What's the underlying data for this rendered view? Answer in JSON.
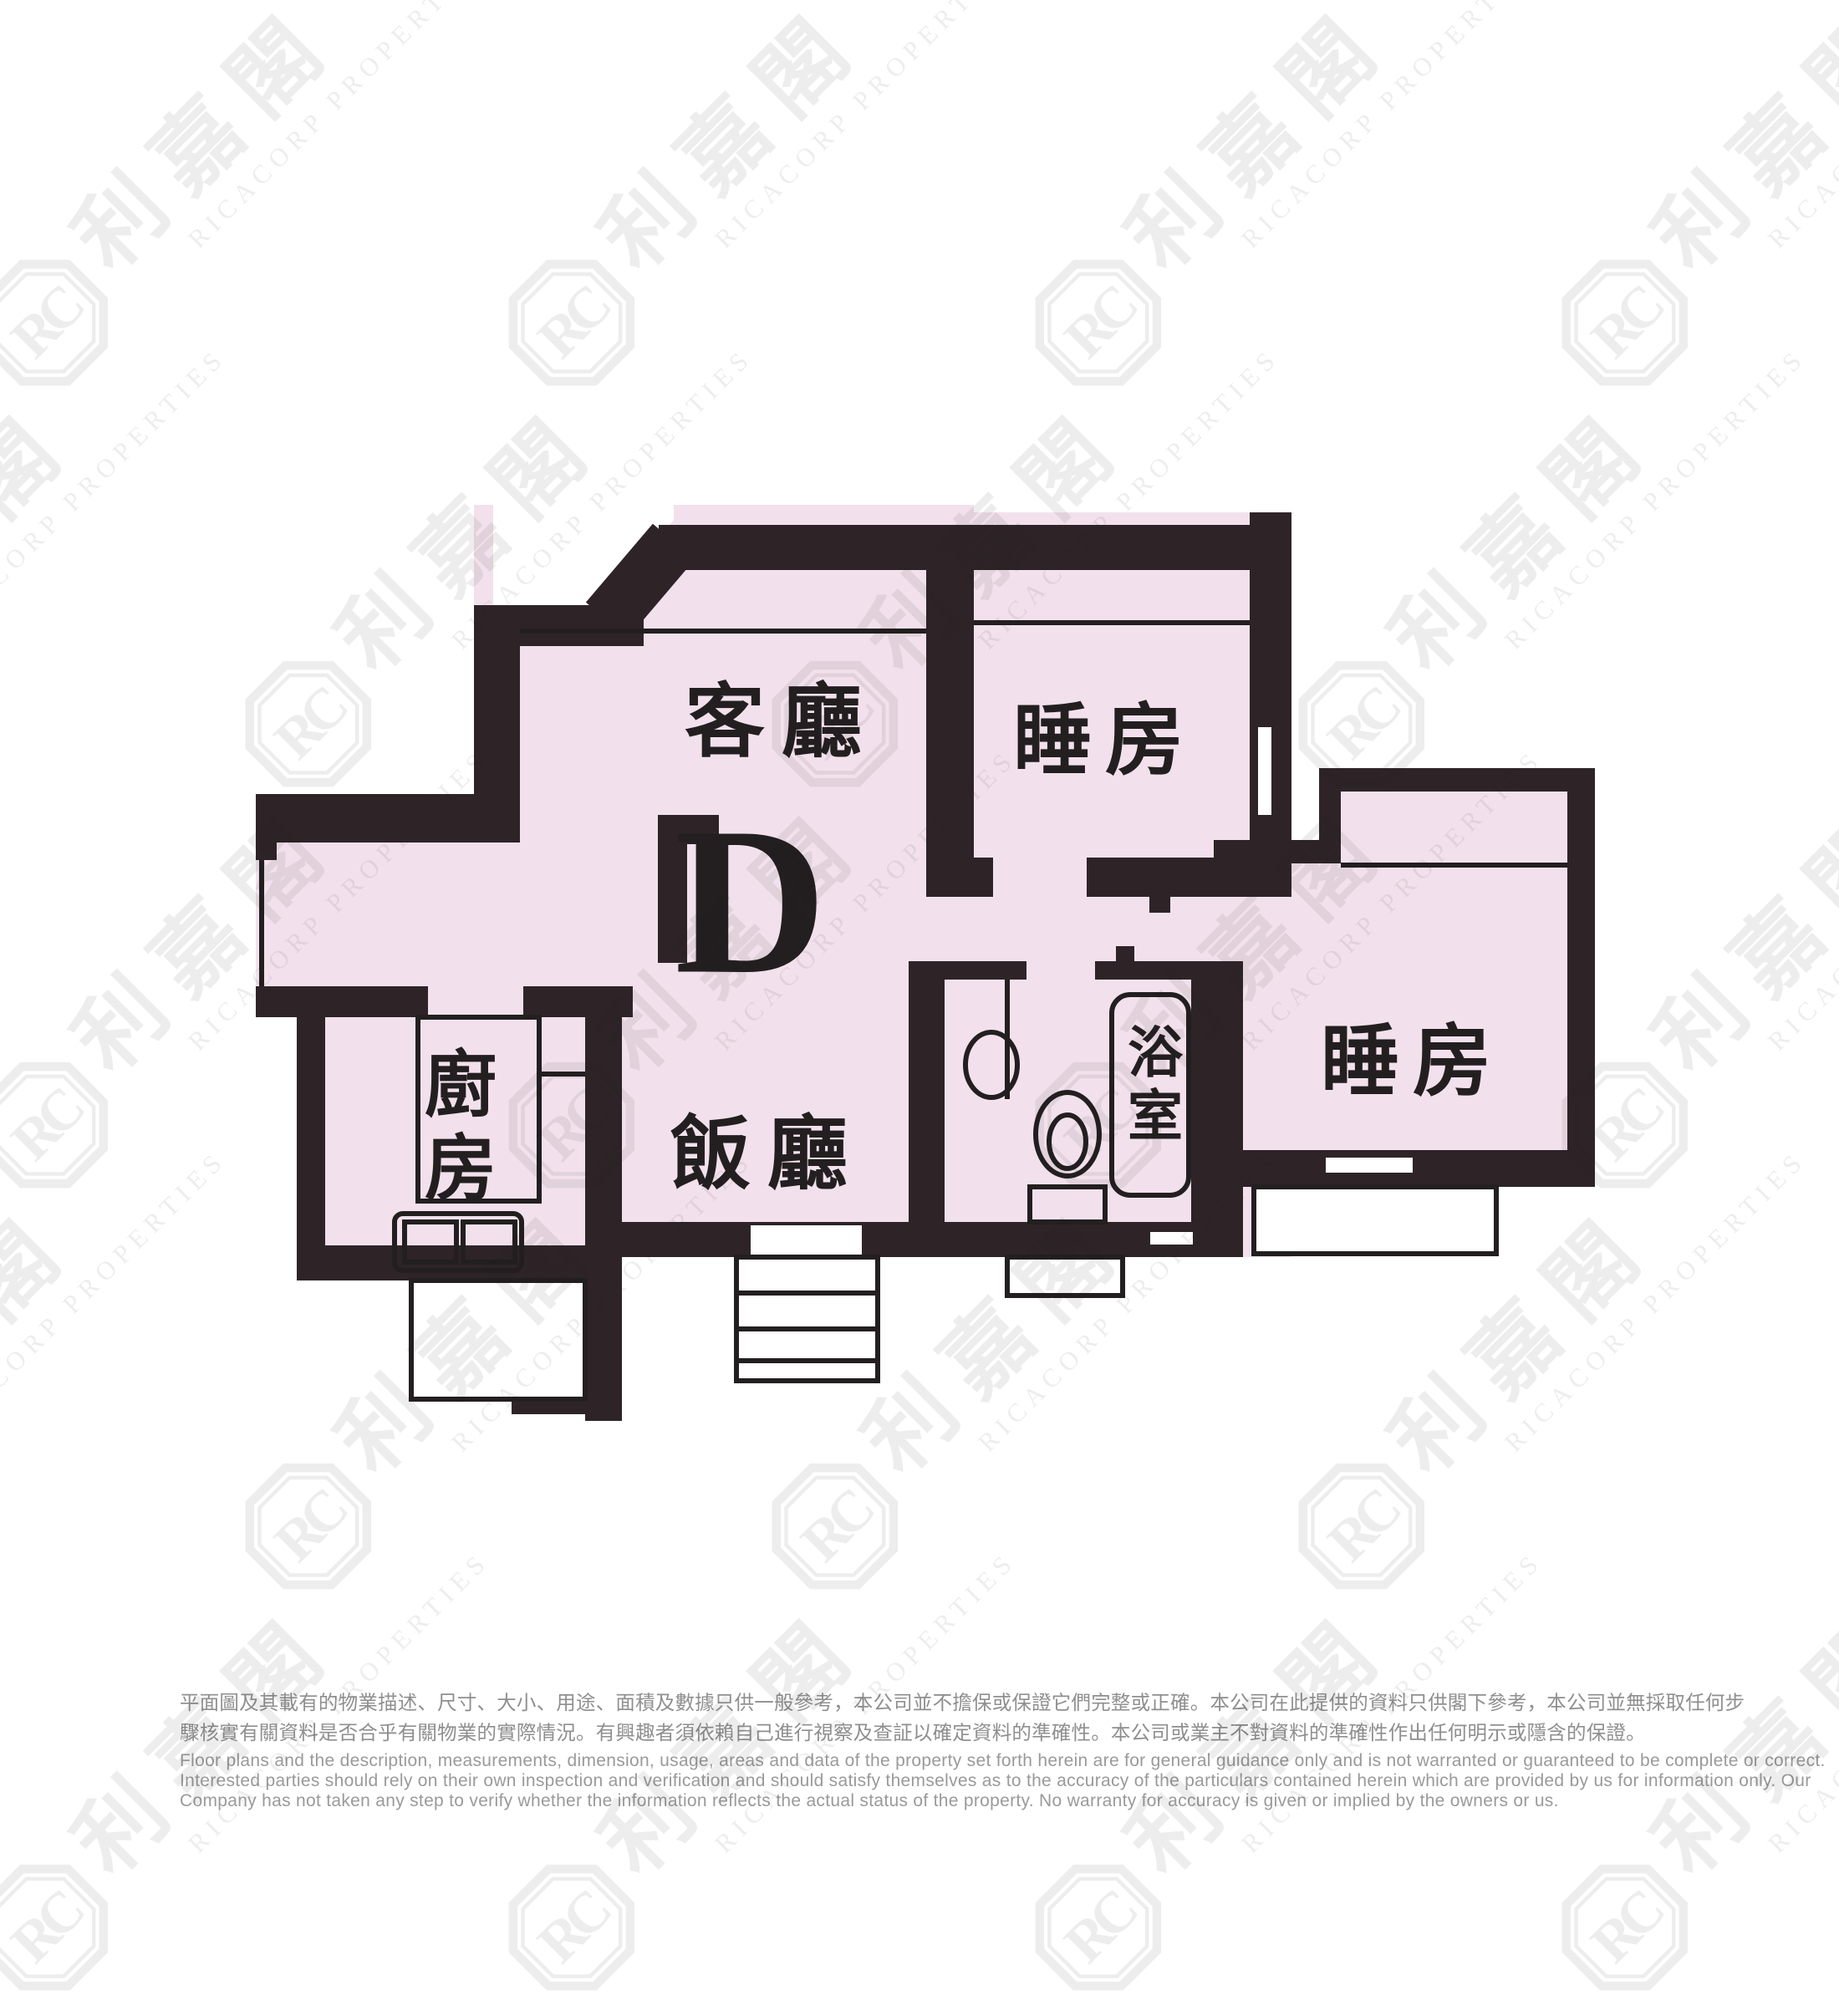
{
  "floor_plan": {
    "unit_label": "D",
    "rooms": [
      {
        "id": "living-room",
        "label": "客廳"
      },
      {
        "id": "bedroom-top",
        "label": "睡房"
      },
      {
        "id": "bedroom-right",
        "label": "睡房"
      },
      {
        "id": "kitchen",
        "label": "廚房"
      },
      {
        "id": "dining-room",
        "label": "飯廳"
      },
      {
        "id": "bathroom",
        "label": "浴室"
      }
    ]
  },
  "watermark": {
    "badge_text": "RC",
    "cjk_text": "利嘉閣",
    "subtext": "RICACORP PROPERTIES"
  },
  "disclaimer": {
    "zh_line1": "平面圖及其載有的物業描述、尺寸、大小、用途、面積及數據只供一般參考，本公司並不擔保或保證它們完整或正確。本公司在此提供的資料只供閣下參考，本公司並無採取任何步",
    "zh_line2": "驟核實有關資料是否合乎有關物業的實際情況。有興趣者須依賴自己進行視察及查証以確定資料的準確性。本公司或業主不對資料的準確性作出任何明示或隱含的保證。",
    "en_line1": "Floor plans and the description, measurements, dimension, usage, areas and data of the property set forth herein are for general guidance only and is not warranted or guaranteed to be complete or correct.",
    "en_line2": "Interested parties should rely on their own inspection and verification and should satisfy themselves as to the accuracy of the particulars contained herein which are provided by us for information only.  Our",
    "en_line3": "Company has not taken any step to verify whether the information reflects the actual status of the property.  No warranty for accuracy is given or implied by the owners or us."
  },
  "colors": {
    "room_fill": "#F2E1EC",
    "wall": "#2E2428",
    "thin_line": "#231F20",
    "label_text": "#231F20",
    "disclaimer_zh": "#8F8F8F",
    "disclaimer_en": "#9A9A9A",
    "watermark": "rgba(25,25,25,0.08)"
  }
}
